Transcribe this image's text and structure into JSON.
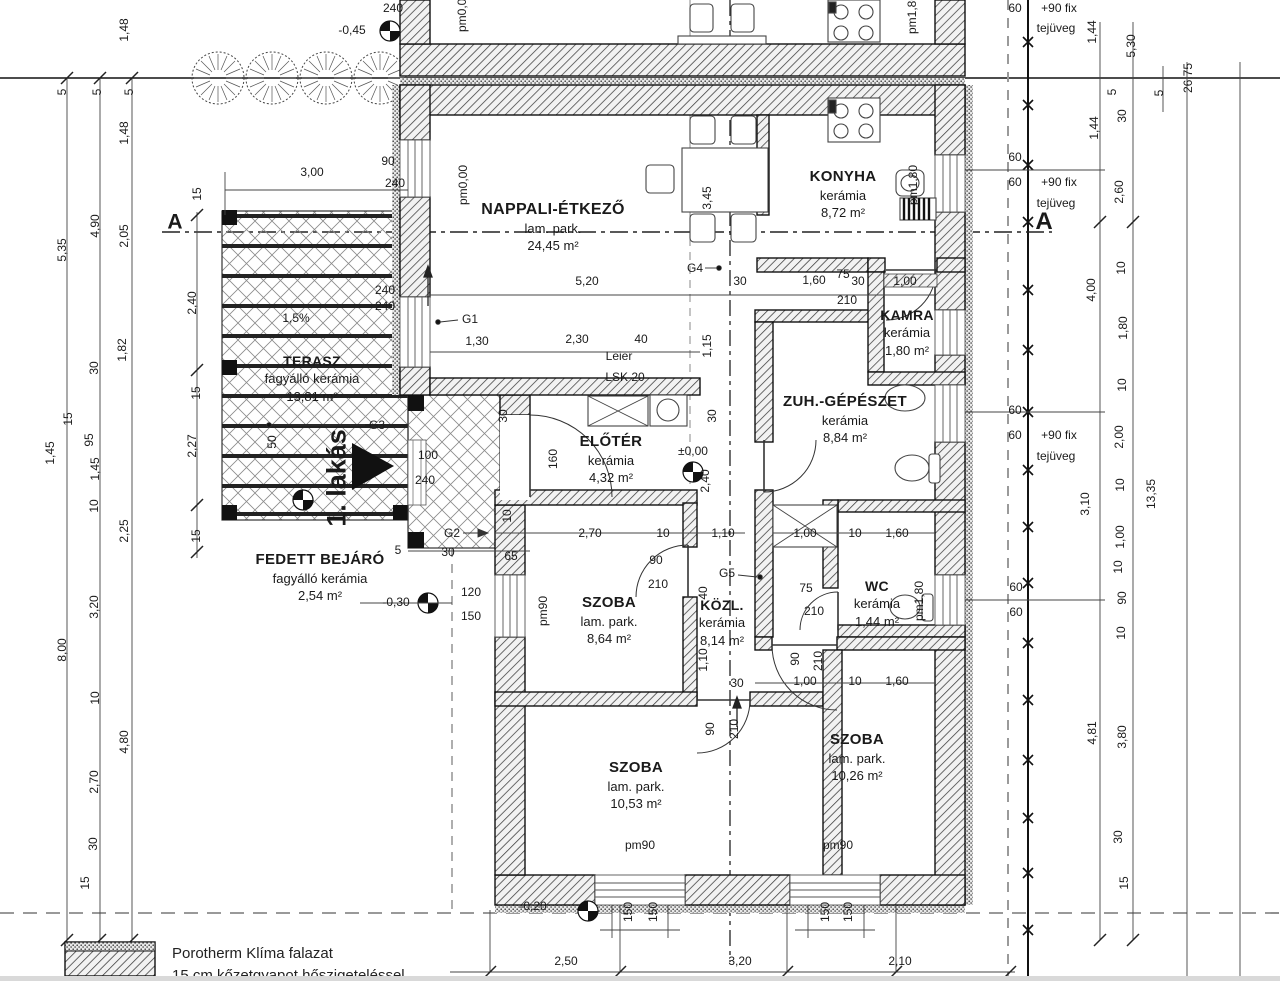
{
  "drawing": {
    "unit_label": "1. lakás",
    "legend": {
      "line1": "Porotherm Klíma falazat",
      "line2": "15 cm kőzetgyapot hőszigeteléssel"
    },
    "rooms": [
      {
        "name": "NAPPALI-ÉTKEZŐ",
        "floor": "lam. park.",
        "area": "24,45 m²",
        "x": 553,
        "y": 199,
        "ns": 16
      },
      {
        "name": "KONYHA",
        "floor": "kerámia",
        "area": "8,72 m²",
        "x": 843,
        "y": 167,
        "ns": 15
      },
      {
        "name": "KAMRA",
        "floor": "kerámia",
        "area": "1,80 m²",
        "x": 907,
        "y": 306,
        "ns": 14
      },
      {
        "name": "ZUH.-GÉPÉSZET",
        "floor": "kerámia",
        "area": "8,84 m²",
        "x": 845,
        "y": 392,
        "ns": 15
      },
      {
        "name": "ELŐTÉR",
        "floor": "kerámia",
        "area": "4,32 m²",
        "x": 611,
        "y": 432,
        "ns": 15
      },
      {
        "name": "SZOBA",
        "floor": "lam. park.",
        "area": "8,64 m²",
        "x": 609,
        "y": 593,
        "ns": 15
      },
      {
        "name": "KÖZL.",
        "floor": "kerámia",
        "area": "8,14 m²",
        "x": 722,
        "y": 596,
        "ns": 14
      },
      {
        "name": "WC",
        "floor": "kerámia",
        "area": "1,44 m²",
        "x": 877,
        "y": 577,
        "ns": 14
      },
      {
        "name": "SZOBA",
        "floor": "lam. park.",
        "area": "10,53 m²",
        "x": 636,
        "y": 758,
        "ns": 15
      },
      {
        "name": "SZOBA",
        "floor": "lam. park.",
        "area": "10,26 m²",
        "x": 857,
        "y": 730,
        "ns": 15
      },
      {
        "name": "TERASZ",
        "floor": "fagyálló kerámia",
        "area": "13,81 m²",
        "x": 312,
        "y": 352,
        "ns": 14
      },
      {
        "name": "FEDETT BEJÁRÓ",
        "floor": "fagyálló kerámia",
        "area": "2,54 m²",
        "x": 320,
        "y": 550,
        "ns": 15
      }
    ],
    "labels": [
      {
        "t": "240",
        "x": 393,
        "y": 8
      },
      {
        "t": "-0,45",
        "x": 352,
        "y": 30,
        "n": "level-label"
      },
      {
        "t": "pm1,80",
        "x": 912,
        "y": 14,
        "r": -90,
        "n": "level-label"
      },
      {
        "t": "pm0,00",
        "x": 462,
        "y": 12,
        "r": -90,
        "n": "level-label"
      },
      {
        "t": "5",
        "x": 62,
        "y": 92,
        "r": -90
      },
      {
        "t": "5",
        "x": 97,
        "y": 92,
        "r": -90
      },
      {
        "t": "5",
        "x": 129,
        "y": 92,
        "r": -90
      },
      {
        "t": "1,48",
        "x": 124,
        "y": 30,
        "r": -90
      },
      {
        "t": "1,48",
        "x": 124,
        "y": 133,
        "r": -90
      },
      {
        "t": "5,35",
        "x": 62,
        "y": 250,
        "r": -90
      },
      {
        "t": "4,90",
        "x": 95,
        "y": 226,
        "r": -90
      },
      {
        "t": "2,05",
        "x": 124,
        "y": 236,
        "r": -90
      },
      {
        "t": "1,82",
        "x": 122,
        "y": 350,
        "r": -90
      },
      {
        "t": "30",
        "x": 94,
        "y": 368,
        "r": -90
      },
      {
        "t": "15",
        "x": 68,
        "y": 419,
        "r": -90
      },
      {
        "t": "95",
        "x": 89,
        "y": 440,
        "r": -90
      },
      {
        "t": "1,45",
        "x": 50,
        "y": 453,
        "r": -90
      },
      {
        "t": "1,45",
        "x": 95,
        "y": 469,
        "r": -90
      },
      {
        "t": "10",
        "x": 94,
        "y": 506,
        "r": -90
      },
      {
        "t": "2,25",
        "x": 124,
        "y": 531,
        "r": -90
      },
      {
        "t": "3,20",
        "x": 94,
        "y": 607,
        "r": -90
      },
      {
        "t": "8,00",
        "x": 62,
        "y": 650,
        "r": -90
      },
      {
        "t": "10",
        "x": 95,
        "y": 698,
        "r": -90
      },
      {
        "t": "4,80",
        "x": 124,
        "y": 742,
        "r": -90
      },
      {
        "t": "2,70",
        "x": 94,
        "y": 782,
        "r": -90
      },
      {
        "t": "30",
        "x": 93,
        "y": 844,
        "r": -90
      },
      {
        "t": "15",
        "x": 85,
        "y": 883,
        "r": -90
      },
      {
        "t": "15",
        "x": 197,
        "y": 194,
        "r": -90
      },
      {
        "t": "2,40",
        "x": 192,
        "y": 303,
        "r": -90
      },
      {
        "t": "15",
        "x": 196,
        "y": 393,
        "r": -90
      },
      {
        "t": "2,27",
        "x": 192,
        "y": 446,
        "r": -90
      },
      {
        "t": "15",
        "x": 196,
        "y": 536,
        "r": -90
      },
      {
        "t": "A",
        "x": 175,
        "y": 222,
        "s": 21,
        "b": 1,
        "n": "section-marker-label"
      },
      {
        "t": "A",
        "x": 1044,
        "y": 222,
        "s": 24,
        "b": 1,
        "n": "section-marker-label"
      },
      {
        "t": "3,00",
        "x": 312,
        "y": 172
      },
      {
        "t": "90",
        "x": 388,
        "y": 161
      },
      {
        "t": "240",
        "x": 395,
        "y": 183
      },
      {
        "t": "pm0,00",
        "x": 463,
        "y": 185,
        "r": -90,
        "n": "level-label"
      },
      {
        "t": "240",
        "x": 385,
        "y": 290
      },
      {
        "t": "240",
        "x": 385,
        "y": 306
      },
      {
        "t": "1,5%",
        "x": 296,
        "y": 318,
        "n": "slope-label"
      },
      {
        "t": "G1",
        "x": 470,
        "y": 319,
        "n": "beam-marker-label"
      },
      {
        "t": "1,30",
        "x": 477,
        "y": 341
      },
      {
        "t": "2,30",
        "x": 577,
        "y": 339
      },
      {
        "t": "40",
        "x": 641,
        "y": 339
      },
      {
        "t": "Leier",
        "x": 619,
        "y": 356,
        "n": "lintel-label"
      },
      {
        "t": "LSK 20",
        "x": 625,
        "y": 377,
        "n": "lintel-label"
      },
      {
        "t": "1,15",
        "x": 707,
        "y": 346,
        "r": -90
      },
      {
        "t": "5,20",
        "x": 587,
        "y": 281
      },
      {
        "t": "G4",
        "x": 695,
        "y": 268,
        "n": "beam-marker-label"
      },
      {
        "t": "30",
        "x": 740,
        "y": 281
      },
      {
        "t": "1,60",
        "x": 814,
        "y": 280
      },
      {
        "t": "75",
        "x": 843,
        "y": 274
      },
      {
        "t": "30",
        "x": 858,
        "y": 281
      },
      {
        "t": "1,00",
        "x": 905,
        "y": 281
      },
      {
        "t": "210",
        "x": 847,
        "y": 300
      },
      {
        "t": "3,45",
        "x": 707,
        "y": 198,
        "r": -90
      },
      {
        "t": "100",
        "x": 428,
        "y": 455
      },
      {
        "t": "240",
        "x": 425,
        "y": 480
      },
      {
        "t": "G3",
        "x": 377,
        "y": 425,
        "n": "beam-marker-label"
      },
      {
        "t": "50",
        "x": 272,
        "y": 442,
        "r": -90
      },
      {
        "t": "1. lakás",
        "x": 337,
        "y": 478,
        "r": -90,
        "s": 27,
        "b": 1,
        "n": "unit-label"
      },
      {
        "t": "G2",
        "x": 452,
        "y": 533,
        "n": "beam-marker-label"
      },
      {
        "t": "5",
        "x": 398,
        "y": 550
      },
      {
        "t": "30",
        "x": 448,
        "y": 552
      },
      {
        "t": "65",
        "x": 511,
        "y": 556
      },
      {
        "t": "-0,30",
        "x": 396,
        "y": 602,
        "n": "level-label"
      },
      {
        "t": "120",
        "x": 471,
        "y": 592
      },
      {
        "t": "150",
        "x": 471,
        "y": 616
      },
      {
        "t": "pm90",
        "x": 543,
        "y": 611,
        "r": -90,
        "n": "level-label"
      },
      {
        "t": "30",
        "x": 503,
        "y": 416,
        "r": -90
      },
      {
        "t": "30",
        "x": 712,
        "y": 416,
        "r": -90
      },
      {
        "t": "160",
        "x": 553,
        "y": 459,
        "r": -90
      },
      {
        "t": "±0,00",
        "x": 693,
        "y": 451,
        "n": "level-label"
      },
      {
        "t": "2,40",
        "x": 705,
        "y": 481,
        "r": -90
      },
      {
        "t": "10",
        "x": 507,
        "y": 516,
        "r": -90
      },
      {
        "t": "2,70",
        "x": 590,
        "y": 533
      },
      {
        "t": "10",
        "x": 663,
        "y": 533
      },
      {
        "t": "1,10",
        "x": 723,
        "y": 533
      },
      {
        "t": "90",
        "x": 656,
        "y": 560
      },
      {
        "t": "210",
        "x": 658,
        "y": 584
      },
      {
        "t": "G5",
        "x": 727,
        "y": 573,
        "n": "beam-marker-label"
      },
      {
        "t": "40",
        "x": 703,
        "y": 593,
        "r": -90
      },
      {
        "t": "1,10",
        "x": 703,
        "y": 660,
        "r": -90
      },
      {
        "t": "30",
        "x": 737,
        "y": 683
      },
      {
        "t": "90",
        "x": 710,
        "y": 729,
        "r": -90
      },
      {
        "t": "210",
        "x": 734,
        "y": 729,
        "r": -90
      },
      {
        "t": "1,00",
        "x": 805,
        "y": 533
      },
      {
        "t": "10",
        "x": 855,
        "y": 533
      },
      {
        "t": "1,60",
        "x": 897,
        "y": 533
      },
      {
        "t": "75",
        "x": 806,
        "y": 588
      },
      {
        "t": "210",
        "x": 814,
        "y": 611
      },
      {
        "t": "pm1,80",
        "x": 919,
        "y": 601,
        "r": -90,
        "n": "level-label"
      },
      {
        "t": "pm1,80",
        "x": 913,
        "y": 185,
        "r": -90,
        "n": "level-label"
      },
      {
        "t": "90",
        "x": 795,
        "y": 659,
        "r": -90
      },
      {
        "t": "210",
        "x": 818,
        "y": 661,
        "r": -90
      },
      {
        "t": "1,00",
        "x": 805,
        "y": 681
      },
      {
        "t": "10",
        "x": 855,
        "y": 681
      },
      {
        "t": "1,60",
        "x": 897,
        "y": 681
      },
      {
        "t": "pm90",
        "x": 640,
        "y": 845,
        "n": "level-label"
      },
      {
        "t": "pm90",
        "x": 838,
        "y": 845,
        "n": "level-label"
      },
      {
        "t": "-0,20",
        "x": 533,
        "y": 906,
        "n": "level-label"
      },
      {
        "t": "150",
        "x": 628,
        "y": 912,
        "r": -90
      },
      {
        "t": "150",
        "x": 653,
        "y": 912,
        "r": -90
      },
      {
        "t": "150",
        "x": 825,
        "y": 912,
        "r": -90
      },
      {
        "t": "150",
        "x": 848,
        "y": 912,
        "r": -90
      },
      {
        "t": "2,50",
        "x": 566,
        "y": 961
      },
      {
        "t": "3,20",
        "x": 740,
        "y": 961
      },
      {
        "t": "2,10",
        "x": 900,
        "y": 961
      },
      {
        "t": "60",
        "x": 1015,
        "y": 8
      },
      {
        "t": "+90 fix",
        "x": 1059,
        "y": 8,
        "n": "window-note-label"
      },
      {
        "t": "tejüveg",
        "x": 1056,
        "y": 28,
        "n": "window-note-label"
      },
      {
        "t": "60",
        "x": 1015,
        "y": 157
      },
      {
        "t": "60",
        "x": 1015,
        "y": 182
      },
      {
        "t": "+90 fix",
        "x": 1059,
        "y": 182,
        "n": "window-note-label"
      },
      {
        "t": "tejüveg",
        "x": 1056,
        "y": 203,
        "n": "window-note-label"
      },
      {
        "t": "60",
        "x": 1015,
        "y": 410
      },
      {
        "t": "60",
        "x": 1015,
        "y": 435
      },
      {
        "t": "+90 fix",
        "x": 1059,
        "y": 435,
        "n": "window-note-label"
      },
      {
        "t": "tejüveg",
        "x": 1056,
        "y": 456,
        "n": "window-note-label"
      },
      {
        "t": "60",
        "x": 1016,
        "y": 587
      },
      {
        "t": "60",
        "x": 1016,
        "y": 612
      },
      {
        "t": "1,44",
        "x": 1092,
        "y": 32,
        "r": -90
      },
      {
        "t": "5",
        "x": 1112,
        "y": 92,
        "r": -90
      },
      {
        "t": "5,30",
        "x": 1131,
        "y": 46,
        "r": -90
      },
      {
        "t": "30",
        "x": 1122,
        "y": 116,
        "r": -90
      },
      {
        "t": "5",
        "x": 1159,
        "y": 93,
        "r": -90
      },
      {
        "t": "26,75",
        "x": 1188,
        "y": 78,
        "r": -90
      },
      {
        "t": "1,44",
        "x": 1094,
        "y": 128,
        "r": -90
      },
      {
        "t": "2,60",
        "x": 1119,
        "y": 192,
        "r": -90
      },
      {
        "t": "10",
        "x": 1121,
        "y": 268,
        "r": -90
      },
      {
        "t": "4,00",
        "x": 1091,
        "y": 290,
        "r": -90
      },
      {
        "t": "1,80",
        "x": 1123,
        "y": 328,
        "r": -90
      },
      {
        "t": "10",
        "x": 1122,
        "y": 385,
        "r": -90
      },
      {
        "t": "2,00",
        "x": 1119,
        "y": 437,
        "r": -90
      },
      {
        "t": "10",
        "x": 1120,
        "y": 485,
        "r": -90
      },
      {
        "t": "13,35",
        "x": 1151,
        "y": 494,
        "r": -90
      },
      {
        "t": "3,10",
        "x": 1085,
        "y": 504,
        "r": -90
      },
      {
        "t": "1,00",
        "x": 1120,
        "y": 537,
        "r": -90
      },
      {
        "t": "10",
        "x": 1118,
        "y": 567,
        "r": -90
      },
      {
        "t": "90",
        "x": 1122,
        "y": 598,
        "r": -90
      },
      {
        "t": "10",
        "x": 1121,
        "y": 633,
        "r": -90
      },
      {
        "t": "4,81",
        "x": 1092,
        "y": 733,
        "r": -90
      },
      {
        "t": "3,80",
        "x": 1122,
        "y": 737,
        "r": -90
      },
      {
        "t": "30",
        "x": 1118,
        "y": 837,
        "r": -90
      },
      {
        "t": "15",
        "x": 1124,
        "y": 883,
        "r": -90
      }
    ]
  }
}
